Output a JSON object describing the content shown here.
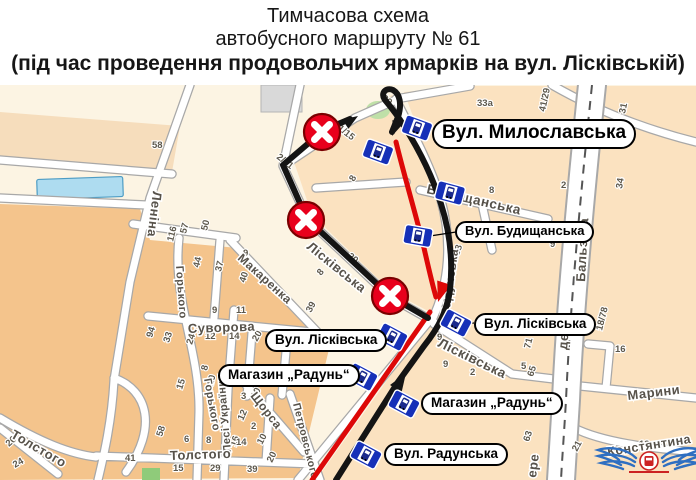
{
  "title": {
    "line1": "Тимчасова схема",
    "line2": "автобусного маршруту № 61",
    "line3": "(під час проведення продовольчих ярмарків на вул. Лісківській)"
  },
  "colors": {
    "map_cream": "#fcf4e3",
    "map_peach": "#fbe2c0",
    "map_orange": "#f4c48c",
    "band_beige": "#f6ddbc",
    "street_casing": "#a8a8a8",
    "route_black": "#141414",
    "route_red": "#dd0808",
    "closure_red": "#e8001c",
    "closure_rim": "#7a0000",
    "stop_blue": "#1630b8",
    "water_blue": "#aedcf0",
    "park_green": "#bfe0a8",
    "logo_blue": "#2f6fc1",
    "logo_red": "#cc2222"
  },
  "map": {
    "callouts": [
      {
        "id": "callout-mylaslavska",
        "text": "Вул. Милославська",
        "x": 432,
        "y": 119,
        "fs": 19
      },
      {
        "id": "callout-budyshchanska",
        "text": "Вул. Будищанська",
        "x": 455,
        "y": 221,
        "fs": 13
      },
      {
        "id": "callout-liskivska-left",
        "text": "Вул. Лісківська",
        "x": 265,
        "y": 329,
        "fs": 13.5
      },
      {
        "id": "callout-mag-radun-left",
        "text": "Магазин „Радунь“",
        "x": 218,
        "y": 364,
        "fs": 13.5
      },
      {
        "id": "callout-liskivska-right",
        "text": "Вул. Лісківська",
        "x": 474,
        "y": 313,
        "fs": 13.5
      },
      {
        "id": "callout-mag-radun-right",
        "text": "Магазин „Радунь“",
        "x": 421,
        "y": 392,
        "fs": 13.5
      },
      {
        "id": "callout-radunska",
        "text": "Вул. Радунська",
        "x": 384,
        "y": 443,
        "fs": 13.5
      }
    ],
    "streets": [
      {
        "name": "Леніна",
        "x": 153,
        "y": 191,
        "rot": 97,
        "fs": 13
      },
      {
        "name": "Макаренка",
        "x": 237,
        "y": 259,
        "rot": 42,
        "fs": 12
      },
      {
        "name": "Горького",
        "x": 176,
        "y": 266,
        "rot": 86,
        "fs": 11
      },
      {
        "name": "Горького",
        "x": 204,
        "y": 379,
        "rot": 80,
        "fs": 11
      },
      {
        "name": "Суворова",
        "x": 188,
        "y": 333,
        "rot": -2,
        "fs": 13
      },
      {
        "name": "Лесі Українки",
        "x": 231,
        "y": 452,
        "rot": -95,
        "fs": 11
      },
      {
        "name": "Щорса",
        "x": 250,
        "y": 396,
        "rot": 52,
        "fs": 12
      },
      {
        "name": "Толстого",
        "x": 170,
        "y": 460,
        "rot": -2,
        "fs": 13
      },
      {
        "name": "Толстого",
        "x": 10,
        "y": 437,
        "rot": 30,
        "fs": 13
      },
      {
        "name": "Петровського",
        "x": 293,
        "y": 404,
        "rot": 76,
        "fs": 10.5
      },
      {
        "name": "Лісківська",
        "x": 306,
        "y": 248,
        "rot": 39,
        "fs": 13
      },
      {
        "name": "Лісківська",
        "x": 437,
        "y": 346,
        "rot": 26,
        "fs": 13.5
      },
      {
        "name": "Радунська",
        "x": 449,
        "y": 316,
        "rot": -82,
        "fs": 12
      },
      {
        "name": "Будищанська",
        "x": 426,
        "y": 193,
        "rot": 13,
        "fs": 13.5
      },
      {
        "name": "Бальзака",
        "x": 585,
        "y": 282,
        "rot": -87,
        "fs": 13,
        "ls": 2
      },
      {
        "name": "де",
        "x": 567,
        "y": 350,
        "rot": -85,
        "fs": 13
      },
      {
        "name": "ере",
        "x": 536,
        "y": 478,
        "rot": -83,
        "fs": 13
      },
      {
        "name": "Марини",
        "x": 628,
        "y": 400,
        "rot": -7,
        "fs": 13
      },
      {
        "name": "Констянтина",
        "x": 608,
        "y": 456,
        "rot": -9,
        "fs": 12.5
      }
    ],
    "house_numbers": [
      {
        "t": "58",
        "x": 152,
        "y": 148,
        "rot": 0
      },
      {
        "t": "39",
        "x": 381,
        "y": 99,
        "rot": 40
      },
      {
        "t": "33а",
        "x": 477,
        "y": 106,
        "rot": 0
      },
      {
        "t": "41/29",
        "x": 545,
        "y": 112,
        "rot": -78
      },
      {
        "t": "31",
        "x": 625,
        "y": 114,
        "rot": -78
      },
      {
        "t": "41/15",
        "x": 333,
        "y": 126,
        "rot": 38
      },
      {
        "t": "2/51",
        "x": 276,
        "y": 158,
        "rot": 38
      },
      {
        "t": "8",
        "x": 354,
        "y": 182,
        "rot": -60
      },
      {
        "t": "8",
        "x": 489,
        "y": 193,
        "rot": 0
      },
      {
        "t": "2",
        "x": 561,
        "y": 188,
        "rot": 0
      },
      {
        "t": "34",
        "x": 622,
        "y": 189,
        "rot": -80
      },
      {
        "t": "1",
        "x": 554,
        "y": 230,
        "rot": 0
      },
      {
        "t": "9",
        "x": 550,
        "y": 247,
        "rot": 0
      },
      {
        "t": "38",
        "x": 459,
        "y": 256,
        "rot": -72
      },
      {
        "t": "20",
        "x": 347,
        "y": 257,
        "rot": 40
      },
      {
        "t": "8",
        "x": 321,
        "y": 276,
        "rot": -50
      },
      {
        "t": "116",
        "x": 173,
        "y": 242,
        "rot": -76
      },
      {
        "t": "57",
        "x": 186,
        "y": 234,
        "rot": -76
      },
      {
        "t": "50",
        "x": 207,
        "y": 231,
        "rot": -76
      },
      {
        "t": "44",
        "x": 199,
        "y": 268,
        "rot": -76
      },
      {
        "t": "37",
        "x": 221,
        "y": 272,
        "rot": -76
      },
      {
        "t": "9",
        "x": 243,
        "y": 256,
        "rot": 0
      },
      {
        "t": "40",
        "x": 245,
        "y": 283,
        "rot": -72
      },
      {
        "t": "39",
        "x": 311,
        "y": 313,
        "rot": -62
      },
      {
        "t": "9",
        "x": 212,
        "y": 313,
        "rot": 0
      },
      {
        "t": "11",
        "x": 236,
        "y": 313,
        "rot": 0
      },
      {
        "t": "94",
        "x": 152,
        "y": 338,
        "rot": -72
      },
      {
        "t": "33",
        "x": 169,
        "y": 343,
        "rot": -72
      },
      {
        "t": "24",
        "x": 192,
        "y": 345,
        "rot": -72
      },
      {
        "t": "12",
        "x": 205,
        "y": 339,
        "rot": 0
      },
      {
        "t": "14",
        "x": 229,
        "y": 339,
        "rot": 0
      },
      {
        "t": "20",
        "x": 257,
        "y": 342,
        "rot": -60
      },
      {
        "t": "15",
        "x": 182,
        "y": 390,
        "rot": -72
      },
      {
        "t": "8",
        "x": 207,
        "y": 371,
        "rot": -76
      },
      {
        "t": "10",
        "x": 213,
        "y": 386,
        "rot": -76
      },
      {
        "t": "3",
        "x": 241,
        "y": 399,
        "rot": 0
      },
      {
        "t": "10",
        "x": 256,
        "y": 399,
        "rot": -62
      },
      {
        "t": "12",
        "x": 243,
        "y": 421,
        "rot": -66
      },
      {
        "t": "2",
        "x": 251,
        "y": 429,
        "rot": 0
      },
      {
        "t": "16",
        "x": 236,
        "y": 447,
        "rot": -72
      },
      {
        "t": "10",
        "x": 262,
        "y": 445,
        "rot": -62
      },
      {
        "t": "58",
        "x": 162,
        "y": 437,
        "rot": -72
      },
      {
        "t": "6",
        "x": 184,
        "y": 442,
        "rot": 0
      },
      {
        "t": "8",
        "x": 206,
        "y": 443,
        "rot": 0
      },
      {
        "t": "14",
        "x": 236,
        "y": 445,
        "rot": 0
      },
      {
        "t": "15",
        "x": 173,
        "y": 471,
        "rot": 0
      },
      {
        "t": "29",
        "x": 210,
        "y": 471,
        "rot": 0
      },
      {
        "t": "39",
        "x": 247,
        "y": 472,
        "rot": 0
      },
      {
        "t": "41",
        "x": 125,
        "y": 461,
        "rot": 0
      },
      {
        "t": "26",
        "x": 9,
        "y": 447,
        "rot": -42
      },
      {
        "t": "24",
        "x": 15,
        "y": 468,
        "rot": -30
      },
      {
        "t": "20",
        "x": 272,
        "y": 463,
        "rot": -64
      },
      {
        "t": "22",
        "x": 335,
        "y": 378,
        "rot": -70
      },
      {
        "t": "9",
        "x": 437,
        "y": 340,
        "rot": 0
      },
      {
        "t": "9",
        "x": 443,
        "y": 367,
        "rot": 0
      },
      {
        "t": "2",
        "x": 470,
        "y": 375,
        "rot": 0
      },
      {
        "t": "71",
        "x": 530,
        "y": 349,
        "rot": -76
      },
      {
        "t": "5",
        "x": 521,
        "y": 369,
        "rot": 0
      },
      {
        "t": "65",
        "x": 533,
        "y": 377,
        "rot": -72
      },
      {
        "t": "63",
        "x": 529,
        "y": 442,
        "rot": -72
      },
      {
        "t": "18/78",
        "x": 602,
        "y": 331,
        "rot": -76
      },
      {
        "t": "16",
        "x": 615,
        "y": 352,
        "rot": 0
      },
      {
        "t": "21",
        "x": 577,
        "y": 452,
        "rot": -62
      },
      {
        "t": "13",
        "x": 639,
        "y": 447,
        "rot": 0
      }
    ],
    "bus_stops": [
      {
        "x": 417,
        "y": 128,
        "rot": 20
      },
      {
        "x": 378,
        "y": 152,
        "rot": 20
      },
      {
        "x": 450,
        "y": 193,
        "rot": 15
      },
      {
        "x": 418,
        "y": 236,
        "rot": 10
      },
      {
        "x": 456,
        "y": 323,
        "rot": 28
      },
      {
        "x": 392,
        "y": 337,
        "rot": 28
      },
      {
        "x": 362,
        "y": 377,
        "rot": 28
      },
      {
        "x": 404,
        "y": 404,
        "rot": 28
      },
      {
        "x": 366,
        "y": 455,
        "rot": 28
      }
    ],
    "closures": [
      {
        "x": 322,
        "y": 132
      },
      {
        "x": 306,
        "y": 220
      },
      {
        "x": 390,
        "y": 296
      }
    ]
  }
}
